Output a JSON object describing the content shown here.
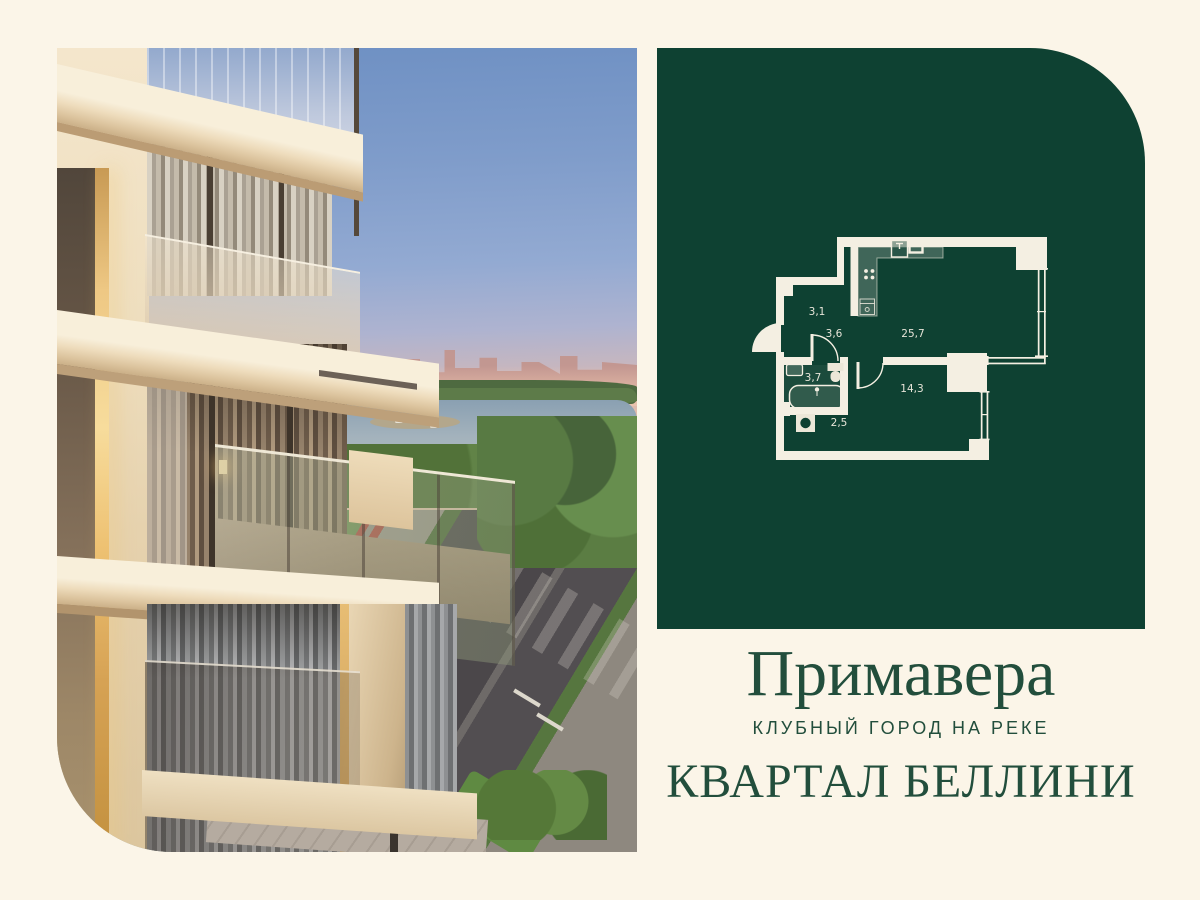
{
  "colors": {
    "page_background": "#fbf5e8",
    "panel_green": "#0e4132",
    "plan_lines": "#f4efe2",
    "brand_text_green": "#224e3c"
  },
  "photo": {
    "label": "building-exterior-render"
  },
  "floor_plan": {
    "rooms": [
      {
        "id": "hallway",
        "area": "3,1"
      },
      {
        "id": "corridor",
        "area": "3,6"
      },
      {
        "id": "kitchen-living",
        "area": "25,7"
      },
      {
        "id": "bathroom",
        "area": "3,7"
      },
      {
        "id": "bedroom",
        "area": "14,3"
      },
      {
        "id": "laundry",
        "area": "2,5"
      }
    ]
  },
  "branding": {
    "title": "Примавера",
    "subtitle": "КЛУБНЫЙ ГОРОД НА РЕКЕ",
    "quarter": "КВАРТАЛ БЕЛЛИНИ"
  }
}
